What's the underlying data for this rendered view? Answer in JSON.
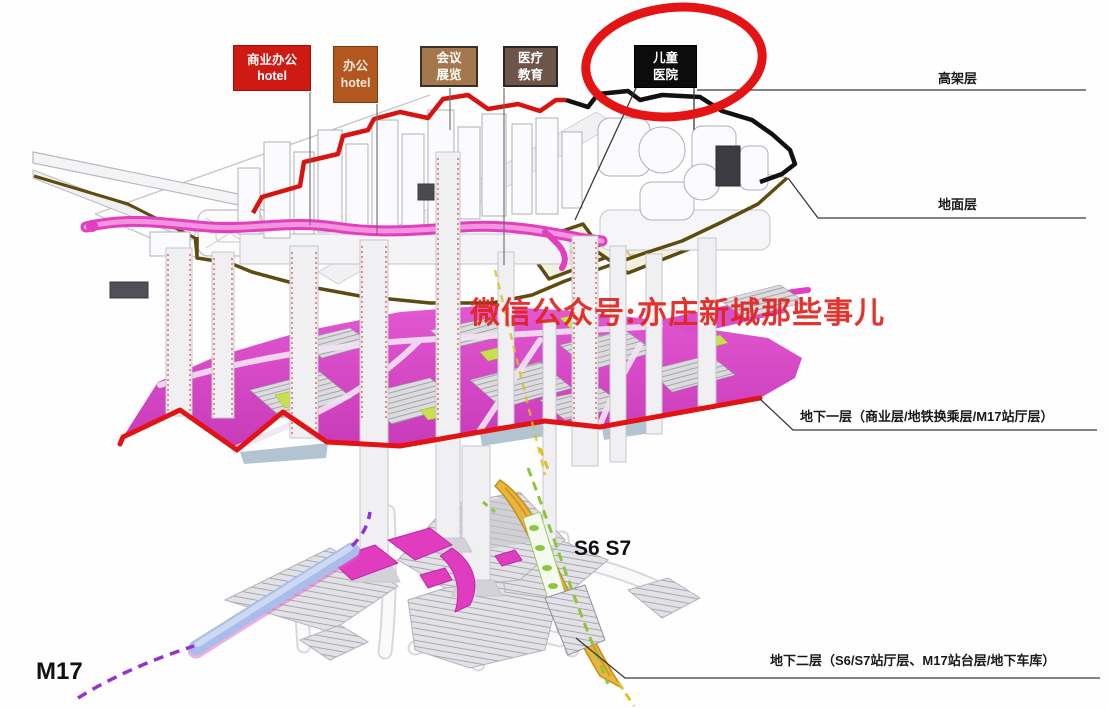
{
  "top_labels": [
    {
      "line1": "商业办公",
      "line2": "hotel",
      "bg": "#cf1a14",
      "text_color": "#ffffff"
    },
    {
      "line1": "办公",
      "line2": "hotel",
      "bg": "#b2571f",
      "text_color": "#f5e9df"
    },
    {
      "line1": "会议",
      "line2": "展览",
      "bg": "#a4784c",
      "text_color": "#ffffff"
    },
    {
      "line1": "医疗",
      "line2": "教育",
      "bg": "#6e554a",
      "text_color": "#ffffff"
    },
    {
      "line1": "儿童",
      "line2": "医院",
      "bg": "#0c0c0c",
      "text_color": "#ffffff",
      "circled": true
    }
  ],
  "layer_labels": [
    {
      "label": "高架层"
    },
    {
      "label": "地面层"
    },
    {
      "label": "地下一层（商业层/地铁换乘层/M17站厅层）"
    },
    {
      "label": "地下二层（S6/S7站厅层、M17站台层/地下车库）"
    }
  ],
  "annotations": {
    "watermark": "微信公众号:亦庄新城那些事儿",
    "metro_line_label": "M17",
    "station_label": "S6 S7"
  },
  "colors": {
    "highlight_circle": "#e41414",
    "level1_front_edge_red": "#e01414",
    "elevated_outline_red": "#d81410",
    "hospital_outline_black": "#111111",
    "ground_edge_brown": "#5f4a10",
    "walkway_pink": "#e23ec0",
    "plate_magenta": "#d94fca",
    "s6s7_platform_yellow": "#eab43e",
    "m17_tube_blue": "#aabdea",
    "m17_dash_purple": "#9333d6",
    "s6s7_dash_green": "#8cc63f"
  }
}
